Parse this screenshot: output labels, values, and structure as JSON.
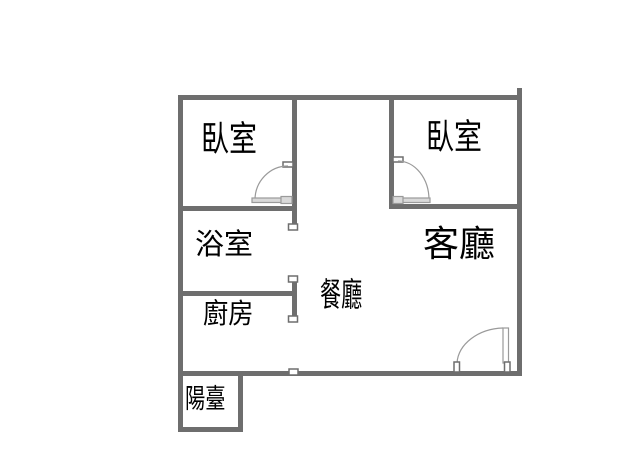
{
  "plan": {
    "type": "apartment-floor-plan",
    "rooms": {
      "bedroom_left": {
        "label": "臥室"
      },
      "bedroom_right": {
        "label": "臥室"
      },
      "bathroom": {
        "label": "浴室"
      },
      "living_room": {
        "label": "客廳"
      },
      "dining_room": {
        "label": "餐廳"
      },
      "kitchen": {
        "label": "廚房"
      },
      "balcony": {
        "label": "陽臺"
      }
    }
  },
  "colors": {
    "wall": "#6e6e6e",
    "door_leaf": "#d9d9d9",
    "door_stroke": "#9a9a9a",
    "marker_fill": "#ffffff",
    "bg": "#ffffff",
    "text": "#000000"
  }
}
